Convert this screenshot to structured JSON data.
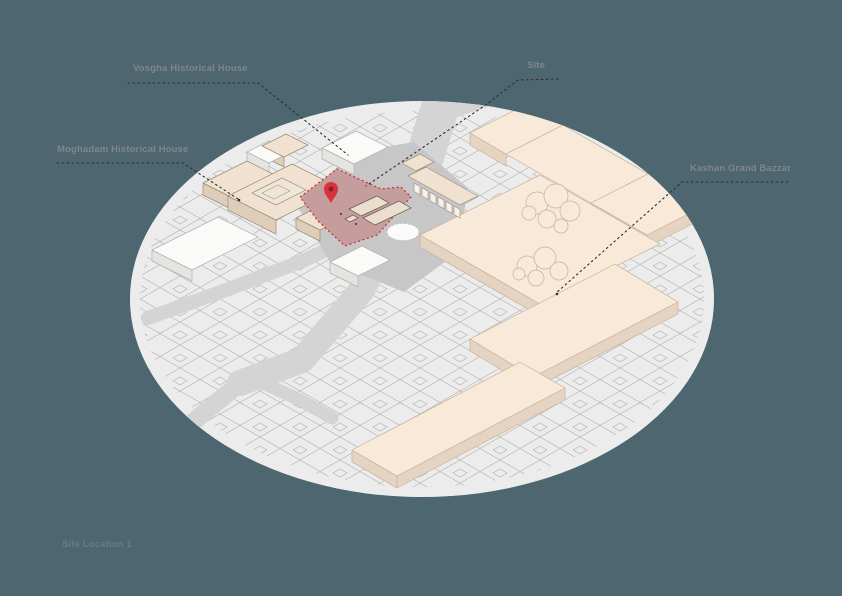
{
  "figure": {
    "type": "axonometric-site-location-diagram",
    "caption": "Site Location 1"
  },
  "annotations": {
    "vosgha": {
      "label": "Vosgha Historical House"
    },
    "site": {
      "label": "Site"
    },
    "moghadam": {
      "label": "Moghadam Historical House"
    },
    "bazaar": {
      "label": "Kashan Grand Bazzar"
    }
  },
  "map": {
    "shape": "elliptical crop",
    "highlight": {
      "name": "site-parcel",
      "style": "red dashed outline with rose fill",
      "marker": "location-pin"
    }
  },
  "colors": {
    "background": "#4d6670",
    "map_base": "#ececec",
    "map_outline": "#b3b0ae",
    "road": "#d4d4d4",
    "plaza": "#c8c7c7",
    "roundabout": "#fbfbfb",
    "bazaar_roof": "#f8e9d8",
    "bazaar_wall": "#e4d4c1",
    "bazaar_stroke": "#c3b19b",
    "house_roof": "#f0e1d0",
    "house_wall": "#decdb8",
    "house_stroke": "#9d8d79",
    "white_building": "#fafaf9",
    "white_building_wall": "#e6e4e0",
    "white_building_stroke": "#b0b0b0",
    "site_fill": "#c69d9d",
    "site_border": "#c63838",
    "pin": "#d6343a",
    "pin_dark": "#8c2026",
    "label_text": "#7e878c",
    "caption_text": "#6f797f",
    "leader": "#2e2e2e"
  }
}
